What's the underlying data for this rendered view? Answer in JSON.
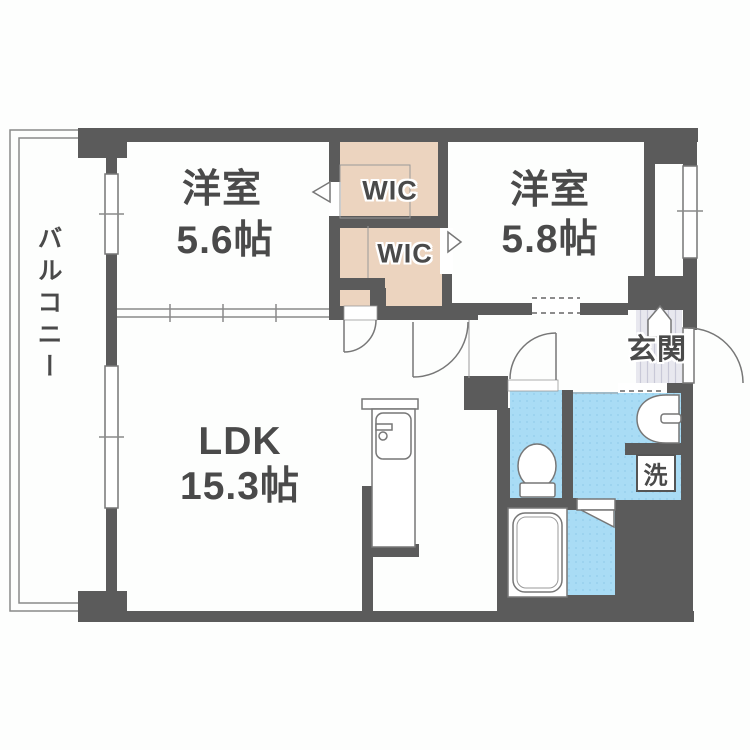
{
  "floorplan": {
    "balcony": {
      "label": "バルコニー"
    },
    "bedroom1": {
      "name": "洋室",
      "size": "5.6帖"
    },
    "bedroom2": {
      "name": "洋室",
      "size": "5.8帖"
    },
    "ldk": {
      "name": "LDK",
      "size": "15.3帖"
    },
    "wic1": {
      "label": "WIC"
    },
    "wic2": {
      "label": "WIC"
    },
    "entrance": {
      "label": "玄関"
    },
    "laundry": {
      "label": "洗"
    },
    "colors": {
      "wall": "#5b5b5b",
      "closet_floor": "#ecd4bf",
      "wet_area_floor": "#a9dcf5",
      "entrance_tile": "#e8e8ef",
      "label_text": "#4a4a4a"
    }
  }
}
